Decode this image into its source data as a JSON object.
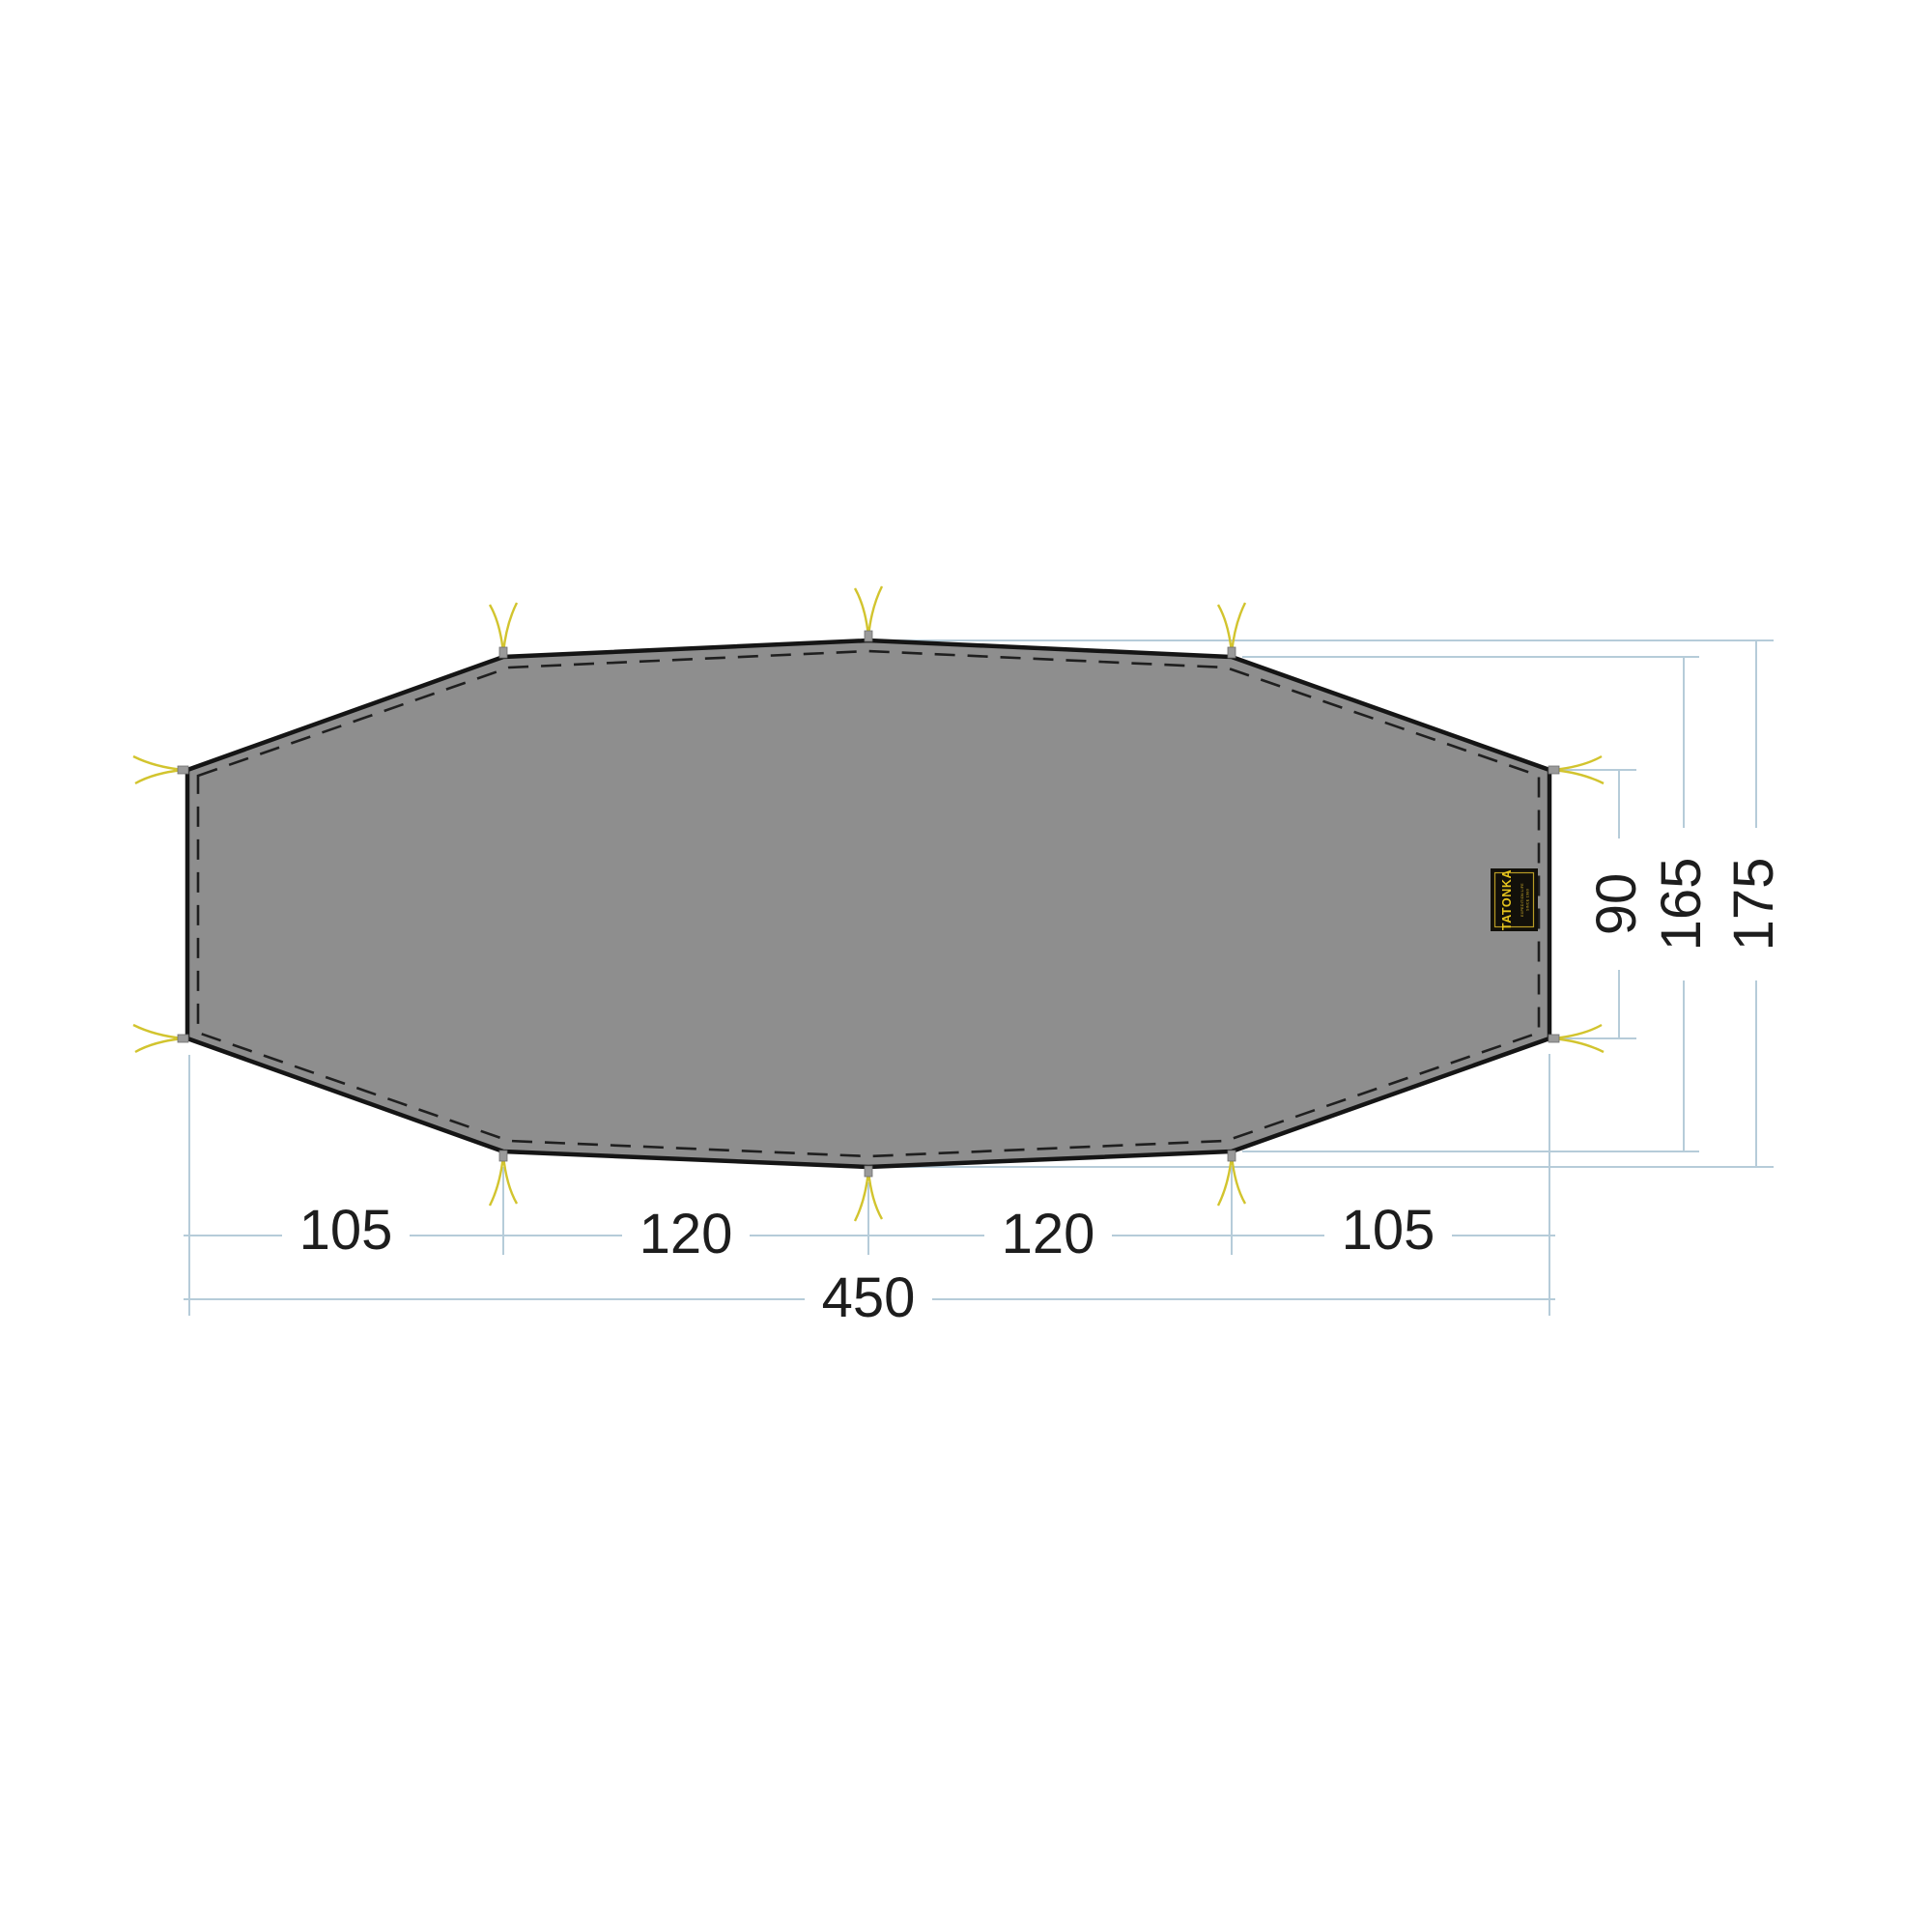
{
  "diagram": {
    "title": "tent-footprint-dimension-drawing",
    "shape_fill_color": "#8e8e8e",
    "outline_color": "#151515",
    "dimension_line_color": "#b6ccd9",
    "tie_color": "#d2c42e",
    "dimension_text_color": "#1d1d1d",
    "bottom_dimensions": [
      "105",
      "120",
      "120",
      "105"
    ],
    "total_width_label": "450",
    "right_dimensions": [
      "90",
      "165",
      "175"
    ],
    "logo": {
      "brand": "TATONKA",
      "line1": "EXPEDITION LIFE",
      "line2": "SINCE 1980",
      "bg_color": "#12100a",
      "accent_color": "#e6c41e"
    }
  }
}
